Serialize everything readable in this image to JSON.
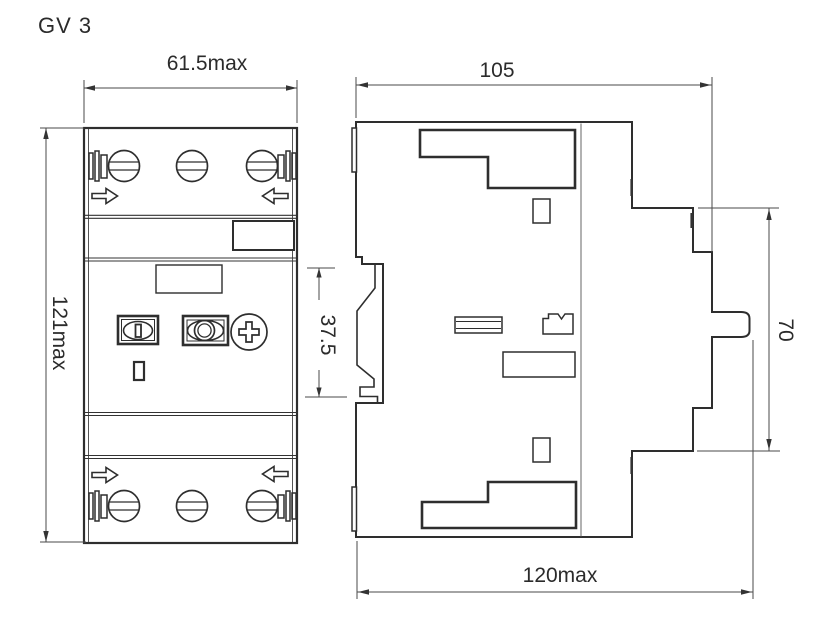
{
  "palette": {
    "background": "#ffffff",
    "outline_color": "#2e2e2e",
    "dimension_line_color": "#4a4a4a",
    "text_color": "#2b2b2b"
  },
  "drawing": {
    "model": "GV 3",
    "front": {
      "width": "61.5max",
      "height": "121max"
    },
    "side": {
      "width": "105",
      "rail": "37.5",
      "height": "70",
      "depth": "120max"
    },
    "icons": {
      "front_view": [
        "screw-terminal-icon",
        "cable-clamp-icon",
        "wire-entry-arrow-icon",
        "start-button-icon",
        "stop-button-icon",
        "adjust-dial-icon",
        "trip-indicator-icon",
        "label-area"
      ],
      "side_view": [
        "din-rail-groove-icon",
        "rotary-shaft-icon",
        "mounting-foot-icon",
        "case-split-line"
      ]
    }
  }
}
